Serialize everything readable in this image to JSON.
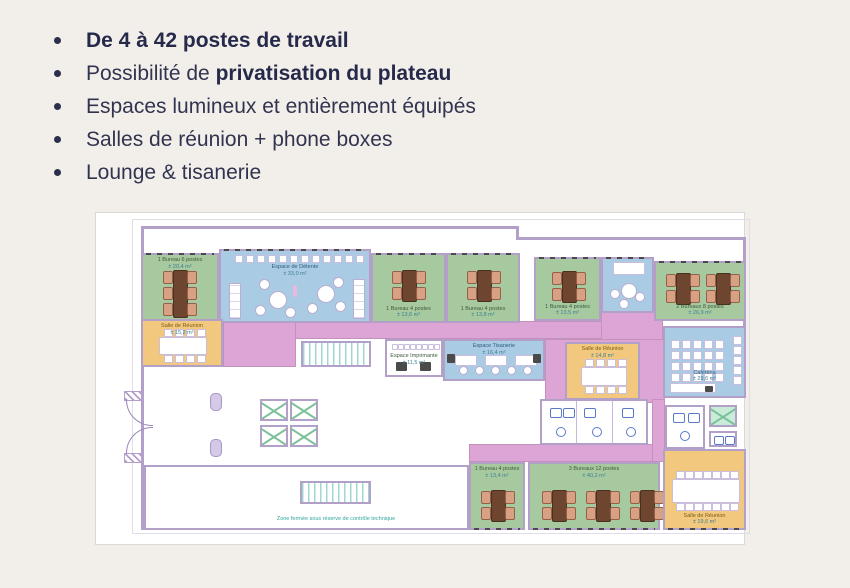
{
  "page": {
    "background": "#f2efeb",
    "text_color": "#32344f"
  },
  "bullets": [
    {
      "segments": [
        {
          "text": "De 4 à 42 postes de travail",
          "bold": true
        }
      ]
    },
    {
      "segments": [
        {
          "text": "Possibilité de ",
          "bold": false
        },
        {
          "text": "privatisation du plateau",
          "bold": true
        }
      ]
    },
    {
      "segments": [
        {
          "text": "Espaces lumineux et entièrement équipés",
          "bold": false
        }
      ]
    },
    {
      "segments": [
        {
          "text": "Salles de réunion + phone boxes",
          "bold": false
        }
      ]
    },
    {
      "segments": [
        {
          "text": "Lounge & tisanerie",
          "bold": false
        }
      ]
    }
  ],
  "plan": {
    "colors": {
      "wall": "#b2a0c9",
      "office_green": "#a6c9a0",
      "common_blue": "#a9cbe3",
      "circulation_pink": "#dca5d6",
      "meeting_orange": "#f1c87d",
      "stairs_teal": "#49b0a6",
      "note_teal": "#2fa79c",
      "desk_brown": "#6e462f"
    },
    "rooms": {
      "office1": {
        "name": "1 Bureau 6 postes",
        "area": "± 20,4 m²"
      },
      "lounge": {
        "name": "Espace de Détente",
        "area": "± 33,0 m²"
      },
      "office2": {
        "name": "1 Bureau 4 postes",
        "area": "± 13,6 m²"
      },
      "office3": {
        "name": "1 Bureau 4 postes",
        "area": "± 13,8 m²"
      },
      "office4": {
        "name": "1 Bureau 4 postes",
        "area": "± 13,5 m²"
      },
      "office5": {
        "name": "2 Bureaux 8 postes",
        "area": "± 26,9 m²"
      },
      "meeting_left": {
        "name": "Salle de Réunion",
        "area": "± 15,2 m²"
      },
      "printer": {
        "name": "Espace Imprimante",
        "area": "± 11,5 m²"
      },
      "kitchen": {
        "name": "Espace Tisanerie",
        "area": "± 16,4 m²"
      },
      "meeting_mid": {
        "name": "Salle de Réunion",
        "area": "± 14,8 m²"
      },
      "cafeteria": {
        "name": "Cafétéria",
        "area": "± 29,6 m²"
      },
      "office6": {
        "name": "1 Bureau 4 postes",
        "area": "± 13,4 m²"
      },
      "office7": {
        "name": "3 Bureaux 12 postes",
        "area": "± 40,2 m²"
      },
      "meeting_right": {
        "name": "Salle de Réunion",
        "area": "± 19,6 m²"
      }
    },
    "note": "Zone fermée sous réserve de contrôle technique"
  }
}
